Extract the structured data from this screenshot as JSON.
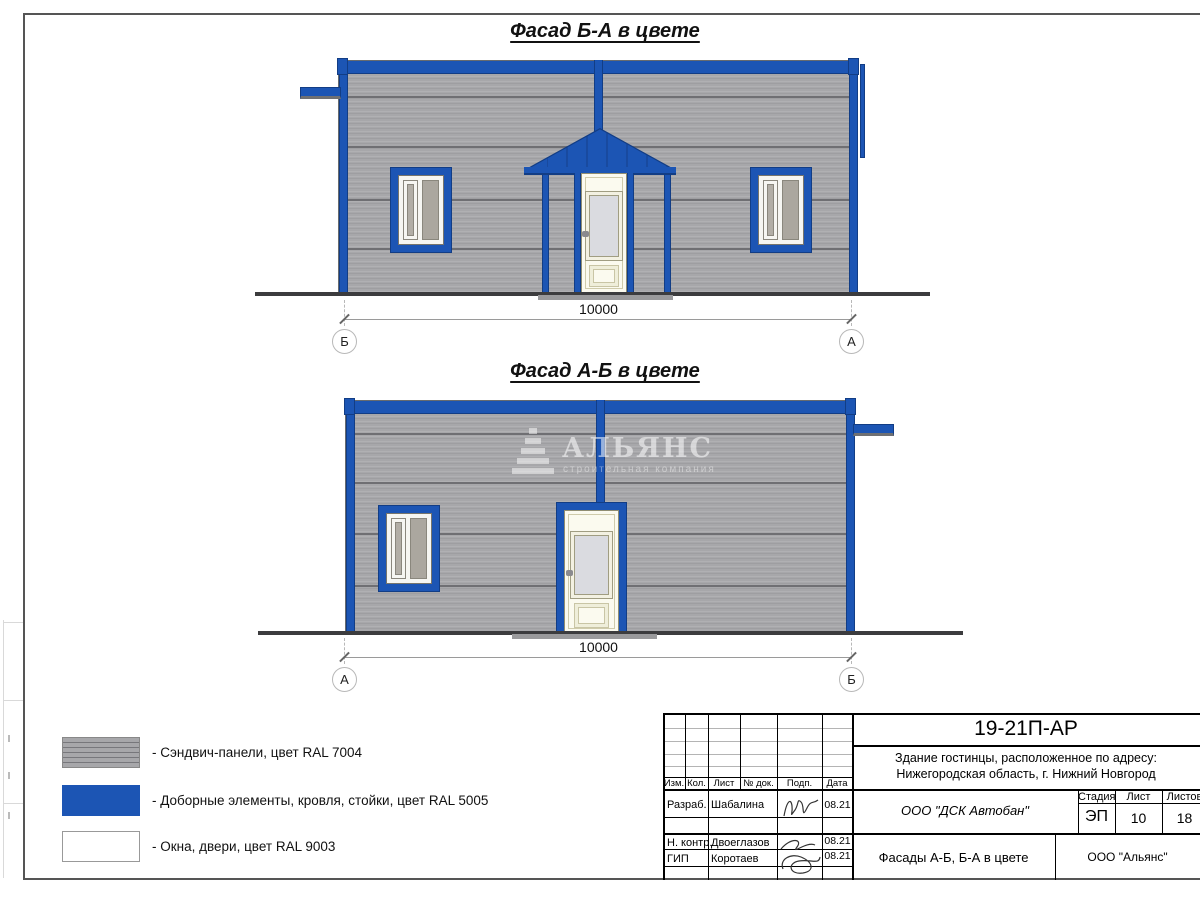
{
  "facade1": {
    "title": "Фасад Б-А в цвете",
    "dimension": "10000",
    "axis_left": "Б",
    "axis_right": "А"
  },
  "facade2": {
    "title": "Фасад А-Б в цвете",
    "dimension": "10000",
    "axis_left": "А",
    "axis_right": "Б"
  },
  "watermark": {
    "name": "АЛЬЯНС",
    "subtitle": "строительная компания"
  },
  "legend": {
    "items": [
      {
        "id": "sandwich-panels",
        "label": "- Сэндвич-панели, цвет RAL 7004",
        "color": "#a7a7aa"
      },
      {
        "id": "trim-elements",
        "label": "- Доборные элементы, кровля, стойки, цвет RAL 5005",
        "color": "#1c55b4"
      },
      {
        "id": "windows-doors",
        "label": "- Окна, двери, цвет RAL 9003",
        "color": "#ffffff"
      }
    ]
  },
  "title_block": {
    "doc_number": "19-21П-АР",
    "project_address_line1": "Здание гостинцы, расположенное по адресу:",
    "project_address_line2": "Нижегородская область, г. Нижний Новгород",
    "columns": [
      "Изм.",
      "Кол.",
      "Лист",
      "№ док.",
      "Подп.",
      "Дата"
    ],
    "signers": [
      {
        "role": "Разраб.",
        "name": "Шабалина",
        "date": "08.21"
      },
      {
        "role": "Н. контр.",
        "name": "Двоеглазов",
        "date": "08.21"
      },
      {
        "role": "ГИП",
        "name": "Коротаев",
        "date": "08.21"
      }
    ],
    "contractor": "ООО \"ДСК Автобан\"",
    "stage_label": "Стадия",
    "sheet_label": "Лист",
    "sheets_label": "Листов",
    "stage": "ЭП",
    "sheet_number": "10",
    "sheets_total": "18",
    "drawing_title": "Фасады А-Б, Б-А в цвете",
    "design_org": "ООО \"Альянс\""
  },
  "colors": {
    "ral5005_blue": "#1c55b4",
    "ral7004_gray": "#a7a7aa",
    "ral9003_white": "#ffffff",
    "panel_seam": "#6f6f73",
    "ground": "#3c3c3e"
  }
}
